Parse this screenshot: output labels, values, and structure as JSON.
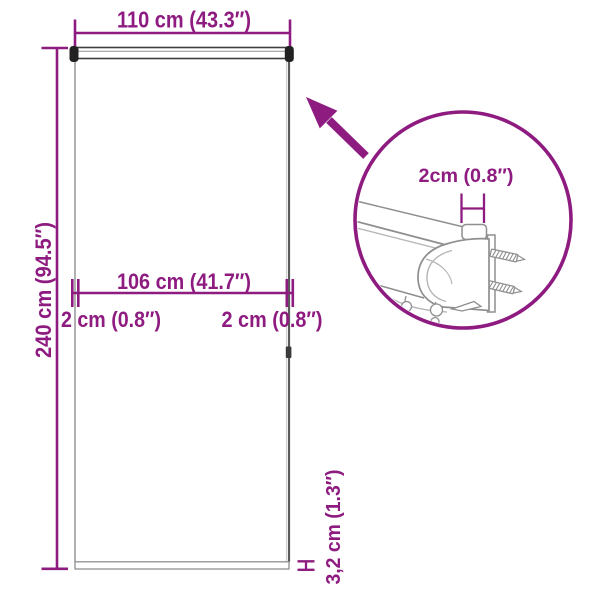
{
  "labels": {
    "total_width": "110 cm (43.3″)",
    "total_height": "240 cm (94.5″)",
    "fabric_width": "106 cm (41.7″)",
    "left_gap": "2 cm (0.8″)",
    "right_gap": "2 cm (0.8″)",
    "bottom_bar_height": "3,2 cm (1.3″)",
    "bracket_depth": "2cm (0.8″)"
  },
  "colors": {
    "accent": "#8e1b80",
    "line": "#8f8f8f",
    "soft": "#b5b5b5",
    "dark": "#222222"
  }
}
